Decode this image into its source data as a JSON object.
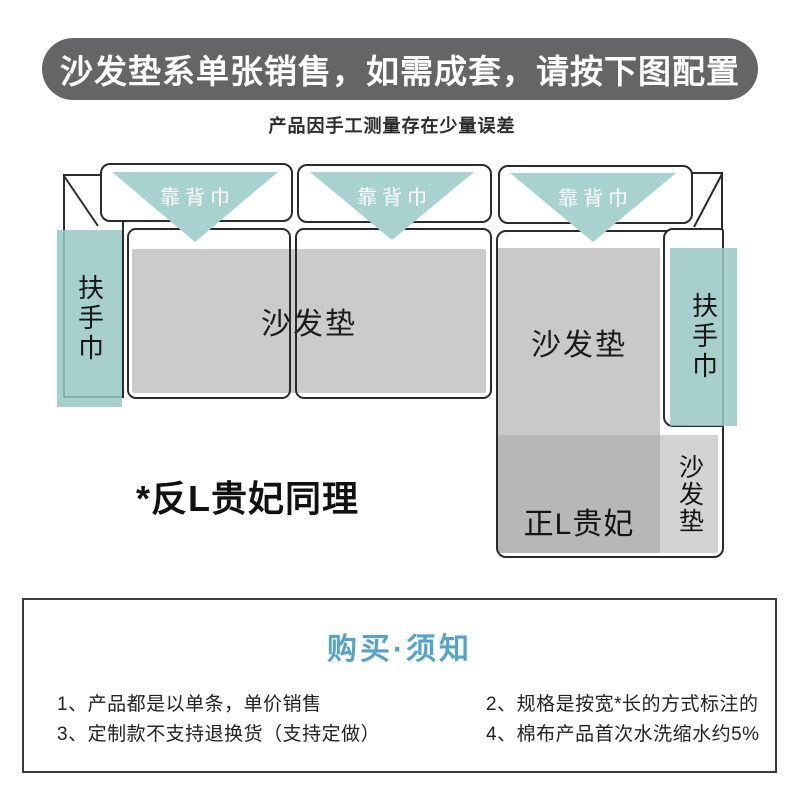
{
  "banner": {
    "text": "沙发垫系单张销售，如需成套，请按下图配置"
  },
  "subtitle": {
    "text": "产品因手工测量存在少量误差"
  },
  "diagram": {
    "backrest_label": "靠背巾",
    "armrest_label": "扶手巾",
    "seat_cushion_label": "沙发垫",
    "chaise_cushion_label": "沙发垫",
    "chaise_strip_label": "沙发垫",
    "chaise_label": "正L贵妃",
    "note": "*反L贵妃同理"
  },
  "notice": {
    "title": "购买·须知",
    "items_left": [
      "1、产品都是以单条，单价销售",
      "3、定制款不支持退换货（支持定做）"
    ],
    "items_right": [
      "2、规格是按宽*长的方式标注的",
      "4、棉布产品首次水洗缩水约5%"
    ]
  },
  "colors": {
    "banner_bg": "#656568",
    "teal": "#a7d2d0",
    "cushion_gray": "#cbcbcb",
    "chaise_dark_gray": "#b7b7b7",
    "chaise_strip_gray": "#d3d3d3",
    "outline": "#2b2b2b",
    "notice_title_blue": "#55a3cb"
  }
}
